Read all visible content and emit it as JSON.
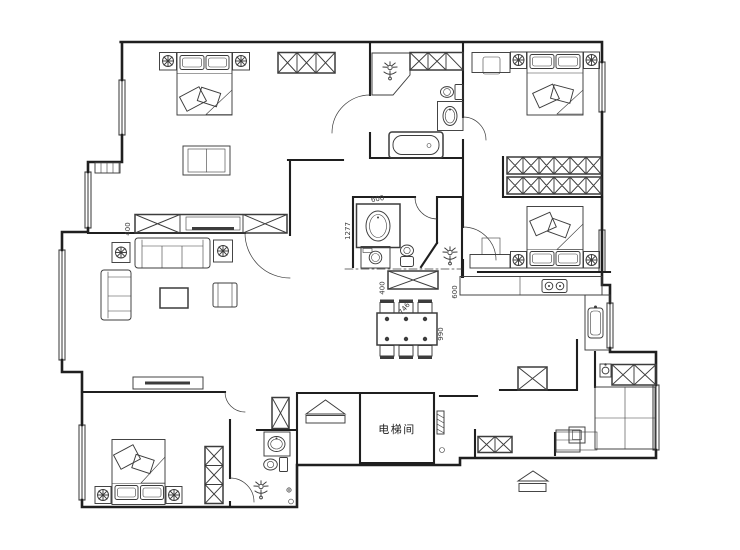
{
  "plan": {
    "type": "apartment-floor-plan",
    "room_labels": {
      "elevator": "电梯间"
    },
    "dimensions": {
      "living_cabinet": "400",
      "vanity_width": "600",
      "vanity_length": "1277",
      "dressing_table": "400",
      "kitchen_counter": "600",
      "dining_chair": "746",
      "dining_table": "990"
    },
    "colors": {
      "wall": "#1f1f1f",
      "furn": "#3c3c3c",
      "dim": "#3c3c3c",
      "background": "#ffffff"
    }
  }
}
